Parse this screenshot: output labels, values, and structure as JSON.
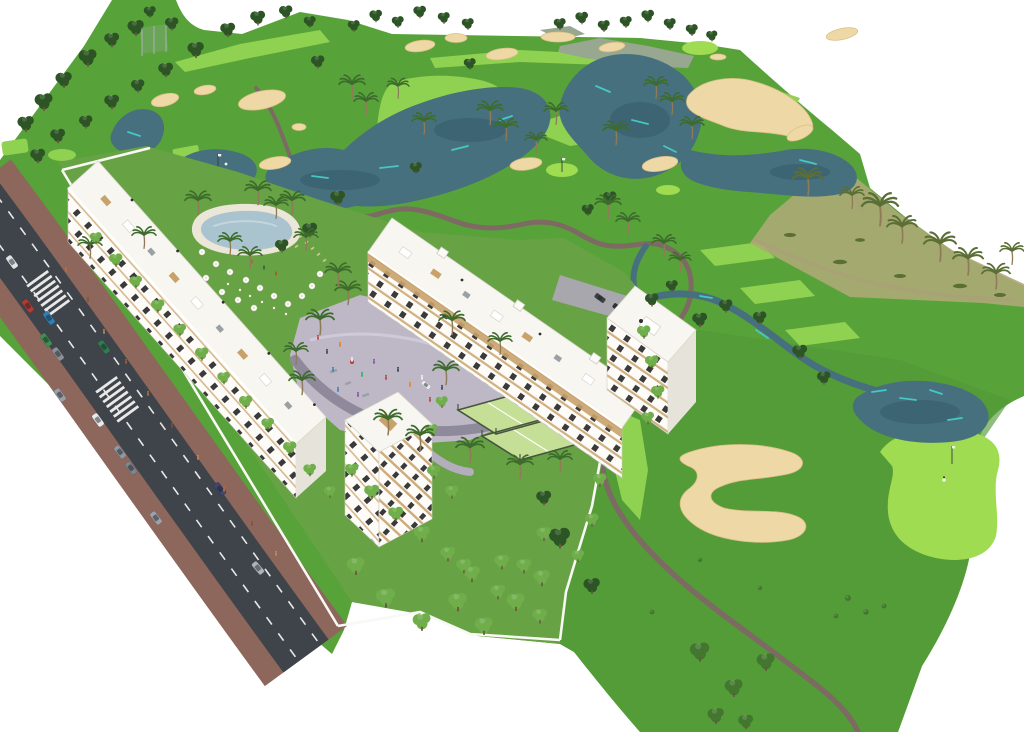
{
  "scene": {
    "type": "3d-aerial-architectural-render",
    "description": "Aerial 3D render of a white low-rise apartment development with pool, plaza and padel courts, beside a golf course with lakes, sand bunkers, cart paths and palm trees, bordered by a road with cars",
    "areas": {
      "golf_course": "golf course with fairways, lakes, bunkers and cart paths",
      "development": "white apartment buildings with gardens, pool, plaza and padel courts",
      "road": "two-way road with parked and moving cars, crosswalks and sidewalks",
      "putting_green": "putting green with flag and golfer"
    }
  },
  "palette": {
    "bg": "#ffffff",
    "grass": "#58a23a",
    "grassRight": "#519a38",
    "devGreen": "#67a244",
    "fairway": "#8fd150",
    "green2": "#9fdc52",
    "treeDark": "#2c5424",
    "treeMid": "#43762f",
    "treeLight": "#6fae4a",
    "palm": "#3c6b2c",
    "palmDry": "#5a6e35",
    "sand": "#eed9a6",
    "sandEdge": "#d9bf85",
    "water": "#47707e",
    "waterDark": "#315865",
    "cyan": "#45c7c3",
    "path": "#7d6a63",
    "road": "#3e4449",
    "sidewalk": "#8d675c",
    "plaza": "#bdb7c6",
    "plazaPath": "#8f8a9b",
    "bldg": "#fdfcf8",
    "bldgShade": "#e6e3da",
    "roof": "#f7f6f0",
    "win": "#3a3a3a",
    "wood": "#c9a26b",
    "poolDeck": "#ece6d8",
    "pool": "#a9c3cf",
    "padel": "#c6df96",
    "padelFence": "#47543f",
    "scrub": "#adaa76",
    "wall": "#f8f8f4",
    "gray": "#9aa0a4",
    "rough": "#98a78f"
  }
}
